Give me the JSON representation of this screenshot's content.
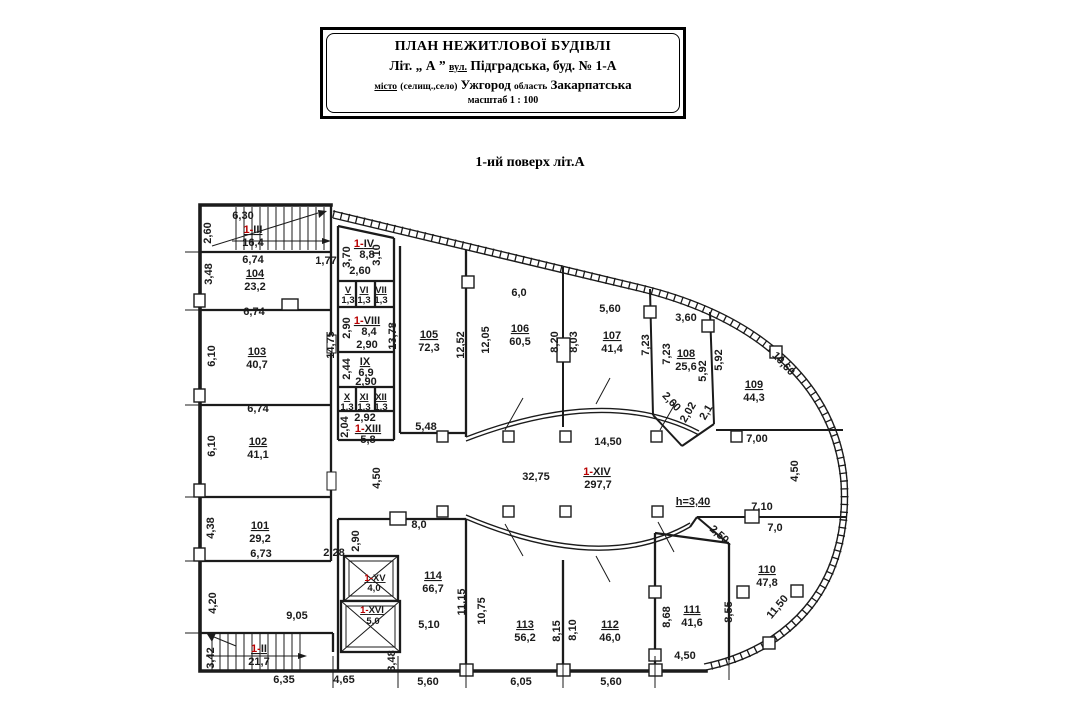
{
  "title_block": {
    "line1": "ПЛАН НЕЖИТЛОВОЇ БУДІВЛІ",
    "line2_prefix": "Літ. „ А ”",
    "line2_label": "вул.",
    "line2_value": "Підградська, буд. № 1-А",
    "line3_label": "місто",
    "line3_note": "(селищ.,село)",
    "line3_city": "Ужгород",
    "line3_region_label": "область",
    "line3_region": "Закарпатська",
    "line4": "масштаб 1 : 100"
  },
  "subtitle": "1-ий поверх літ.А",
  "colors": {
    "room_number": "#b90000",
    "lines": "#1b1b1b"
  },
  "rooms": {
    "101": {
      "num": "101",
      "area": "29,2"
    },
    "102": {
      "num": "102",
      "area": "41,1"
    },
    "103": {
      "num": "103",
      "area": "40,7"
    },
    "104": {
      "num": "104",
      "area": "23,2"
    },
    "105": {
      "num": "105",
      "area": "72,3"
    },
    "106": {
      "num": "106",
      "area": "60,5"
    },
    "107": {
      "num": "107",
      "area": "41,4"
    },
    "108": {
      "num": "108",
      "area": "25,6"
    },
    "109": {
      "num": "109",
      "area": "44,3"
    },
    "110": {
      "num": "110",
      "area": "47,8"
    },
    "111": {
      "num": "111",
      "area": "41,6"
    },
    "112": {
      "num": "112",
      "area": "46,0"
    },
    "113": {
      "num": "113",
      "area": "56,2"
    },
    "114": {
      "num": "114",
      "area": "66,7"
    }
  },
  "halls": {
    "II": {
      "p": "1-",
      "r": "II",
      "area": "21,7"
    },
    "III": {
      "p": "1-",
      "r": "III",
      "area": "16,4"
    },
    "IV": {
      "p": "1-",
      "r": "IV",
      "area": "8,8"
    },
    "VIII": {
      "p": "1-",
      "r": "VIII",
      "area": "8,4"
    },
    "XIII": {
      "p": "1-",
      "r": "XIII",
      "area": "5,8"
    },
    "XIV": {
      "p": "1-",
      "r": "XIV",
      "area": "297,7"
    },
    "XV": {
      "p": "1-",
      "r": "XV",
      "area": "4,0"
    },
    "XVI": {
      "p": "1-",
      "r": "XVI",
      "area": "5,0"
    }
  },
  "cells": {
    "V": {
      "id": "V",
      "area": "1,3"
    },
    "VI": {
      "id": "VI",
      "area": "1,3"
    },
    "VII": {
      "id": "VII",
      "area": "1,3"
    },
    "IX": {
      "id": "IX",
      "area": "6,9"
    },
    "X": {
      "id": "X",
      "area": "1,3"
    },
    "XI": {
      "id": "XI",
      "area": "1,3"
    },
    "XII": {
      "id": "XII",
      "area": "1,3"
    }
  },
  "dims": {
    "st3_w": "6,30",
    "st3_h": "2,60",
    "r104_w": "6,74",
    "r104_h": "3,48",
    "gap_svc": "1,77",
    "r103_w": "6,74",
    "r103_h": "6,10",
    "r102_w": "6,74",
    "r102_h": "6,10",
    "r101_h": "4,38",
    "r101_w": "6,73",
    "below101_h": "4,20",
    "hall_l_w": "9,05",
    "st2_h": "3,42",
    "st2_w": "6,35",
    "bot_2": "4,65",
    "h4_l": "3,70",
    "h4_r": "3,10",
    "h4_b": "2,60",
    "svc_col_h": "14,75",
    "h8_l": "2,90",
    "h8_b": "2,90",
    "c9_l": "2,44",
    "c9_b": "2,90",
    "row_x_w": "2,92",
    "h13_l": "2,04",
    "r105_l": "13,78",
    "r105_r": "12,52",
    "r105_b": "5,48",
    "r106_t": "6,0",
    "r106_l": "12,05",
    "r106_r": "8,20",
    "r107_t": "5,60",
    "r107_l": "8,03",
    "r107_r": "7,23",
    "r108_t": "3,60",
    "r108_l": "7,23",
    "r108_r1": "5,92",
    "r108_r2": "5,92",
    "r108_d1": "2,60",
    "r108_d2": "2,02",
    "r108_d3": "2,1",
    "r109_c": "10,60",
    "r109_b": "7,00",
    "hall_t": "14,50",
    "hall_w": "32,75",
    "hall_lh": "4,50",
    "right_v": "4,50",
    "cor_t": "7,10",
    "cor_b": "7,0",
    "cor_d": "2,50",
    "height_note": "h=3,40",
    "r110_c": "11,50",
    "r110_l": "8,55",
    "r111_l": "8,68",
    "r111_b": "4,50",
    "r112_l": "8,10",
    "r112_b": "5,60",
    "r113_l": "10,75",
    "r113_r": "8,15",
    "r113_b": "6,05",
    "r114_t": "8,0",
    "r114_tl": "2,90",
    "r114_gap": "2,28",
    "r114_m": "5,10",
    "r114_r": "11,15",
    "r114_b": "5,60",
    "shaft_b": "3,48"
  }
}
